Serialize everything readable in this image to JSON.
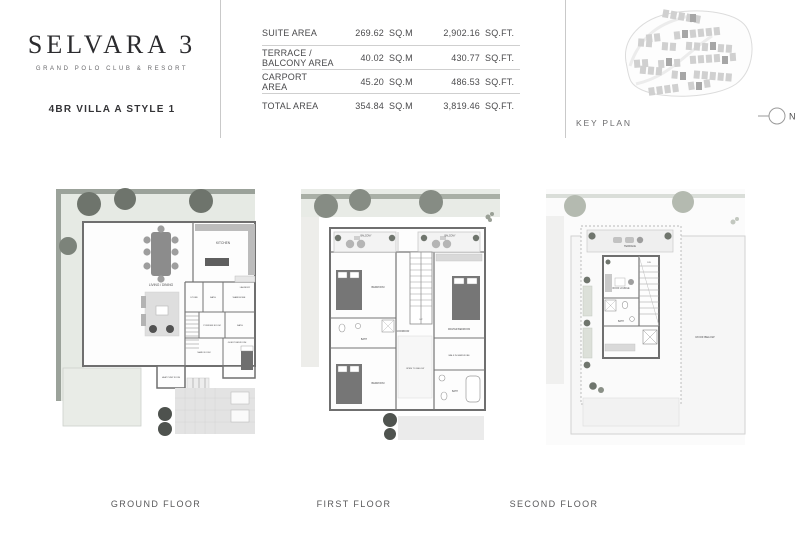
{
  "colors": {
    "page_bg": "#ffffff",
    "text_dark": "#2b2b2e",
    "text_mid": "#4a4a4c",
    "rule_line": "#c9c9c9",
    "plan_wall": "#6f6f6f",
    "garden": "#e6eae4",
    "tree": "#6e746c"
  },
  "header": {
    "logo": {
      "title": "SELVARA 3",
      "tagline": "GRAND POLO CLUB & RESORT"
    },
    "villa_title": "4BR VILLA A STYLE 1",
    "area_table": {
      "rows": [
        {
          "label": "SUITE AREA",
          "sqm": "269.62",
          "sqm_unit": "SQ.M",
          "sqft": "2,902.16",
          "sqft_unit": "SQ.FT."
        },
        {
          "label": "TERRACE / BALCONY AREA",
          "sqm": "40.02",
          "sqm_unit": "SQ.M",
          "sqft": "430.77",
          "sqft_unit": "SQ.FT."
        },
        {
          "label": "CARPORT AREA",
          "sqm": "45.20",
          "sqm_unit": "SQ.M",
          "sqft": "486.53",
          "sqft_unit": "SQ.FT."
        },
        {
          "label": "TOTAL AREA",
          "sqm": "354.84",
          "sqm_unit": "SQ.M",
          "sqft": "3,819.46",
          "sqft_unit": "SQ.FT."
        }
      ]
    },
    "key_plan": {
      "label": "KEY PLAN",
      "north_label": "N"
    }
  },
  "plans": {
    "ground": {
      "label": "GROUND FLOOR",
      "rooms": {
        "living": "LIVING / DINING",
        "kitchen": "KITCHEN",
        "laundry": "LAUNDRY",
        "store": "STORE",
        "bath1": "BATH",
        "wardrobe": "WARDROBE",
        "powder": "POWDER ROOM",
        "bath2": "BATH",
        "maid": "MAID ROOM",
        "guest": "GUEST BEDROOM",
        "heat_pump": "HEAT PUMP ROOM"
      }
    },
    "first": {
      "label": "FIRST FLOOR",
      "rooms": {
        "balcony_left": "BALCONY",
        "balcony_right": "BALCONY",
        "bedroom_top": "BEDROOM",
        "master": "MASTER BEDROOM",
        "corridor": "CORRIDOR",
        "bath_mid": "BATH",
        "bedroom_bottom": "BEDROOM",
        "walk_in": "WALK IN WARDROBE",
        "bath_right": "BATH",
        "open_below": "OPEN TO BELOW",
        "up": "UP"
      }
    },
    "second": {
      "label": "SECOND FLOOR",
      "rooms": {
        "terrace": "TERRACE",
        "lounge": "ROOF LOUNGE",
        "bath": "BATH",
        "dn": "DN",
        "roof": "ROOF BELOW"
      }
    }
  }
}
